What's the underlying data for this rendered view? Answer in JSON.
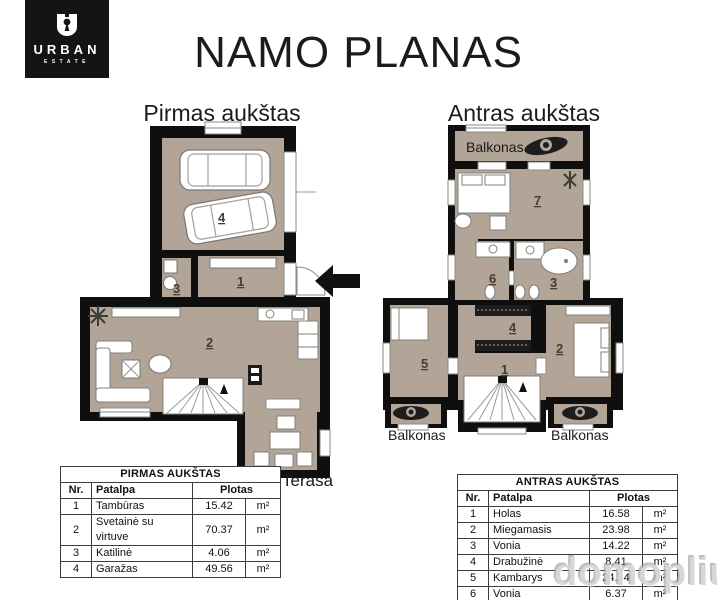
{
  "brand": {
    "name": "URBAN",
    "sub": "ESTATE"
  },
  "title": "NAMO PLANAS",
  "floor1": {
    "heading": "Pirmas aukštas",
    "terrace_label": "Terasa",
    "rooms": {
      "hall": "1",
      "living": "2",
      "boiler": "3",
      "garage": "4"
    }
  },
  "floor2": {
    "heading": "Antras aukštas",
    "balcony_top": "Balkonas",
    "balcony_left": "Balkonas",
    "balcony_right": "Balkonas",
    "rooms": {
      "hall": "1",
      "bedroom": "2",
      "bath_big": "3",
      "wardrobe": "4",
      "room5": "5",
      "bath_small": "6",
      "room7": "7"
    }
  },
  "tables": {
    "first": {
      "title": "PIRMAS AUKŠTAS",
      "col_nr": "Nr.",
      "col_room": "Patalpa",
      "col_area": "Plotas",
      "rows": [
        {
          "nr": "1",
          "name": "Tambūras",
          "area": "15.42",
          "unit": "m²"
        },
        {
          "nr": "2",
          "name": "Svetainė su virtuve",
          "area": "70.37",
          "unit": "m²"
        },
        {
          "nr": "3",
          "name": "Katilinė",
          "area": "4.06",
          "unit": "m²"
        },
        {
          "nr": "4",
          "name": "Garažas",
          "area": "49.56",
          "unit": "m²"
        }
      ]
    },
    "second": {
      "title": "ANTRAS AUKŠTAS",
      "col_nr": "Nr.",
      "col_room": "Patalpa",
      "col_area": "Plotas",
      "rows": [
        {
          "nr": "1",
          "name": "Holas",
          "area": "16.58",
          "unit": "m²"
        },
        {
          "nr": "2",
          "name": "Miegamasis",
          "area": "23.98",
          "unit": "m²"
        },
        {
          "nr": "3",
          "name": "Vonia",
          "area": "14.22",
          "unit": "m²"
        },
        {
          "nr": "4",
          "name": "Drabužinė",
          "area": "8.41",
          "unit": "m²"
        },
        {
          "nr": "5",
          "name": "Kambarys",
          "area": "24.34",
          "unit": "m²"
        },
        {
          "nr": "6",
          "name": "Vonia",
          "area": "6.37",
          "unit": "m²"
        },
        {
          "nr": "7",
          "name": "Kambarys",
          "area": "28.28",
          "unit": "m²"
        }
      ]
    }
  },
  "watermark": "domoplius.lt",
  "colors": {
    "floor_fill": "#b2a496",
    "wall": "#0f0f0f",
    "logo_bg": "#141416"
  }
}
